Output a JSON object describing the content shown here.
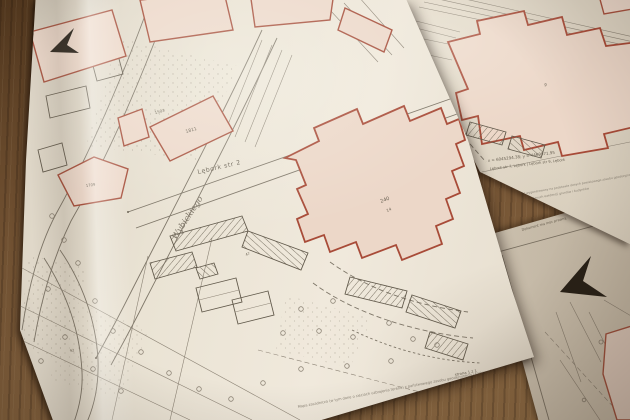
{
  "colors": {
    "paper": "#ece5d8",
    "building_fill": "#edd9cb",
    "building_stroke": "#a8523f",
    "map_line": "#7e7668",
    "wood": "#6b4e33"
  },
  "main_sheet": {
    "street_label": "Lębork str 2",
    "handwritten_label": "Wybickiego",
    "parcel_1503": "1503",
    "parcel_1811": "1811",
    "parcel_240": "240",
    "parcel_14": "14",
    "parcel_1709": "1709",
    "parcel_92": "92",
    "parcel_47": "47",
    "fine_print": "Mapa zasadnicza (w tym dane o sieciach uzbrojenia terenu) z państwowego zasobu geodezyjnego i kartograficznego",
    "page_label": "strona 1 z 1"
  },
  "right_sheet": {
    "coord_label": "x = 6045294.38; y = 4469971.95",
    "address_label": "Lębork str 7, Lębork | Lębork str 9, Lębork",
    "parcel_9": "9",
    "fine_print_1": "Dokument wygenerowany na podstawie danych powiatowego zasobu geodezyjnego i kartograficznego",
    "fine_print_2": "na podstawie danych ewidencji gruntów i budynków"
  },
  "bottom_sheet": {
    "note_label": "Dokument ma moc prawną"
  }
}
